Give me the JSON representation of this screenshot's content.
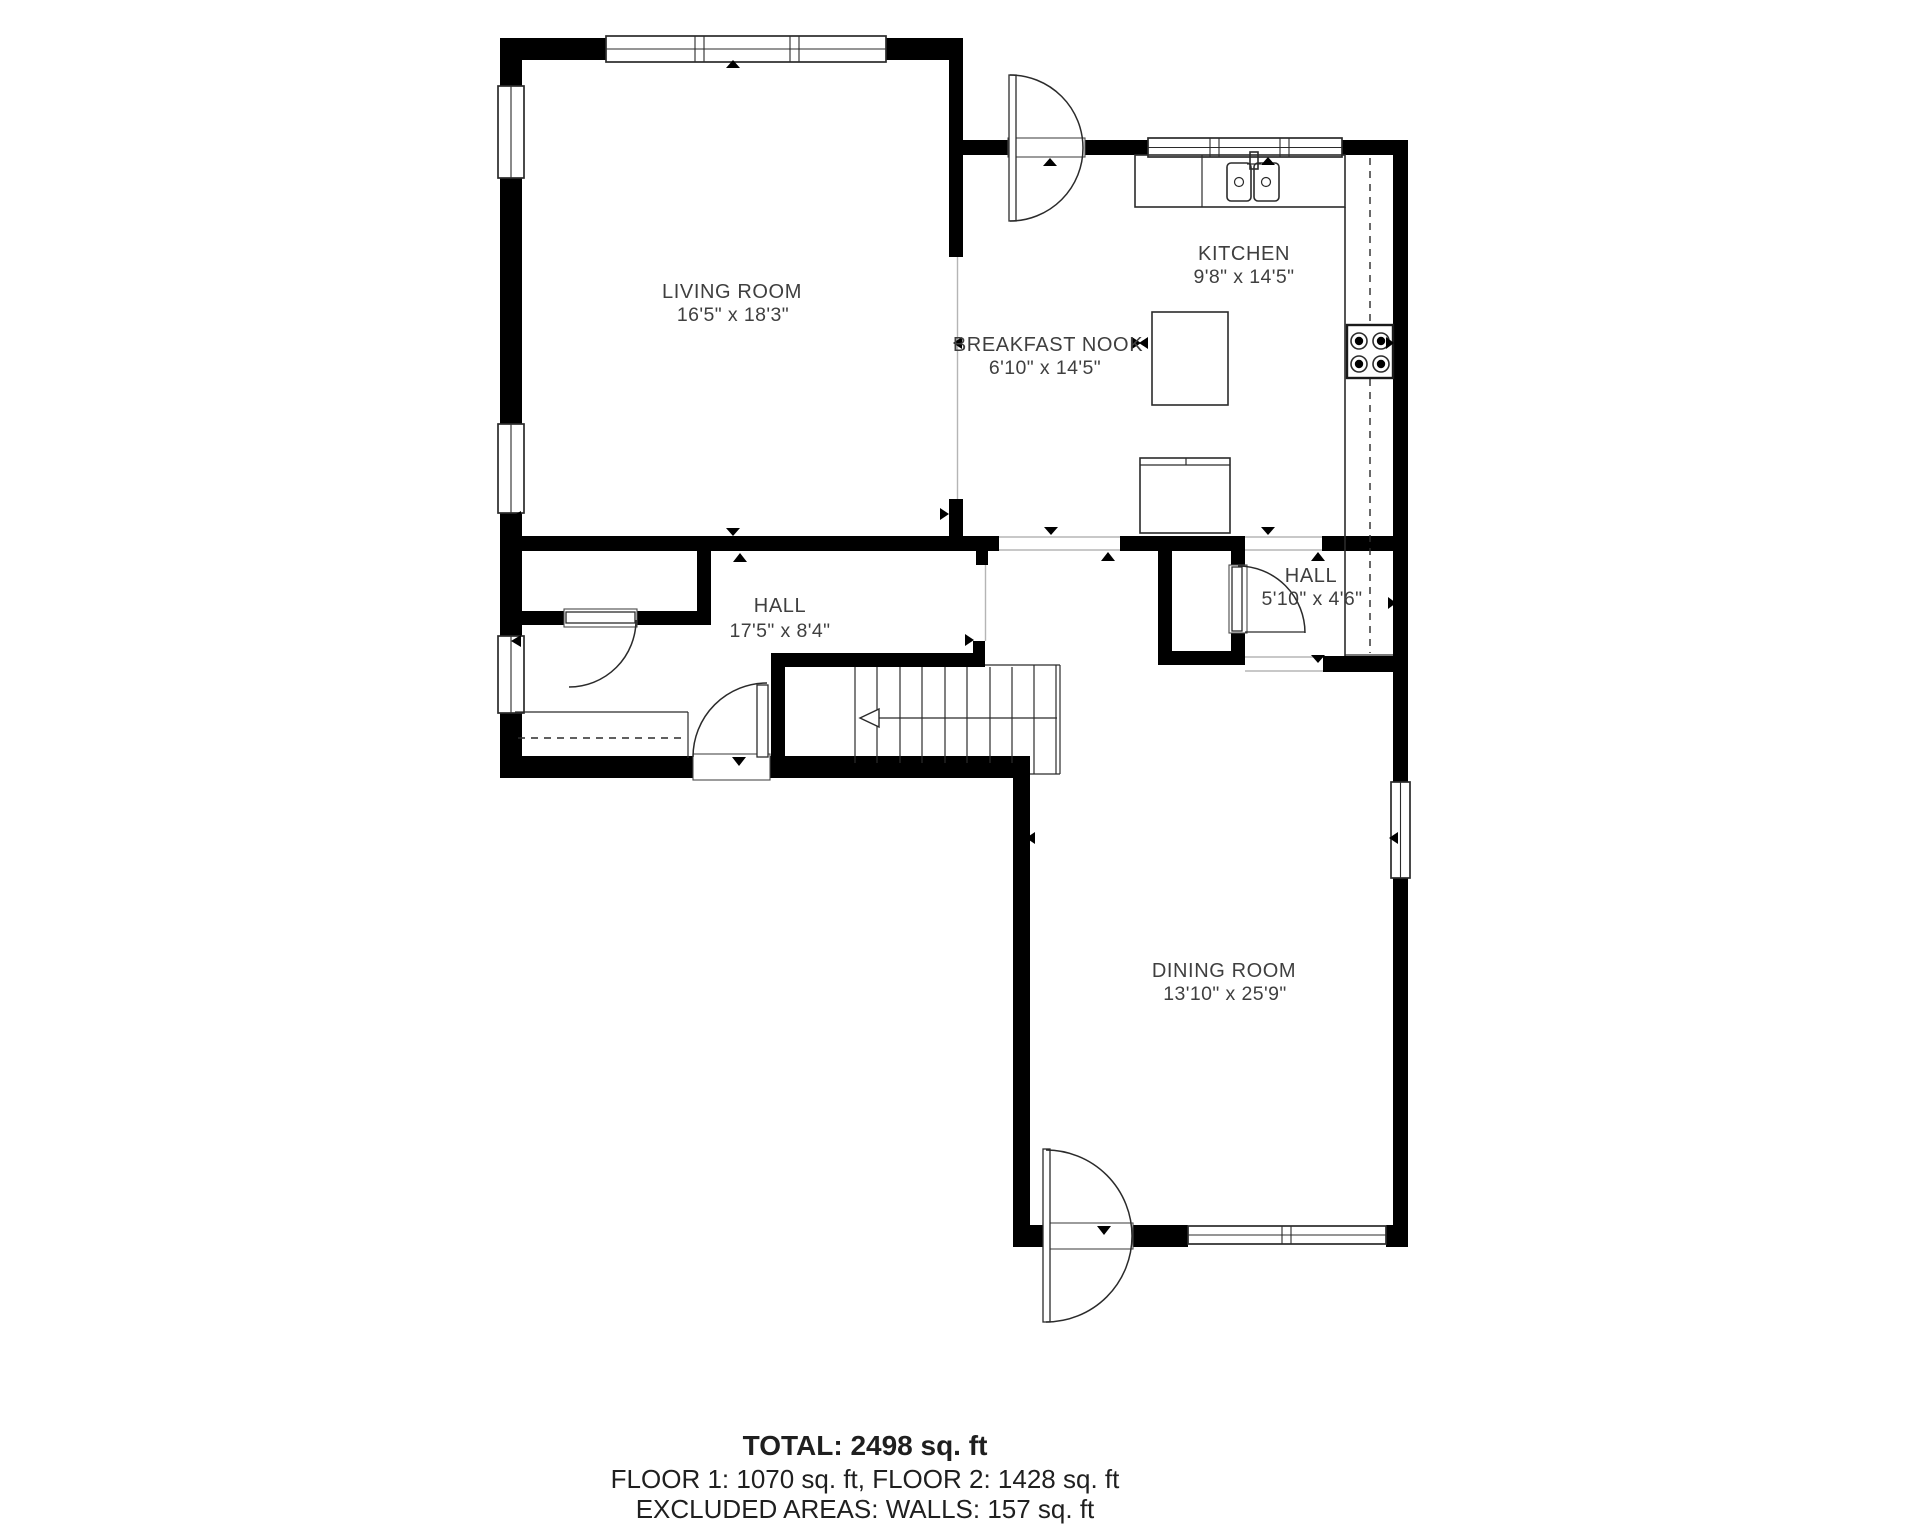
{
  "rooms": {
    "living_room": {
      "name": "LIVING ROOM",
      "dims": "16'5\" x 18'3\""
    },
    "kitchen": {
      "name": "KITCHEN",
      "dims": "9'8\" x 14'5\""
    },
    "breakfast_nook": {
      "name": "BREAKFAST NOOK",
      "dims": "6'10\" x 14'5\""
    },
    "hall_main": {
      "name": "HALL",
      "dims": "17'5\" x 8'4\""
    },
    "hall_small": {
      "name": "HALL",
      "dims": "5'10\" x 4'6\""
    },
    "dining_room": {
      "name": "DINING ROOM",
      "dims": "13'10\" x 25'9\""
    }
  },
  "summary": {
    "total": "TOTAL: 2498 sq. ft",
    "floors": "FLOOR 1: 1070 sq. ft, FLOOR 2: 1428 sq. ft",
    "excluded": "EXCLUDED AREAS: WALLS: 157 sq. ft"
  },
  "colors": {
    "wall": "#000000",
    "label": "#3f3f3f",
    "text": "#1f1f1f",
    "fixture": "#2b2b2b",
    "virtual": "#b5b5b5",
    "background": "#ffffff"
  }
}
